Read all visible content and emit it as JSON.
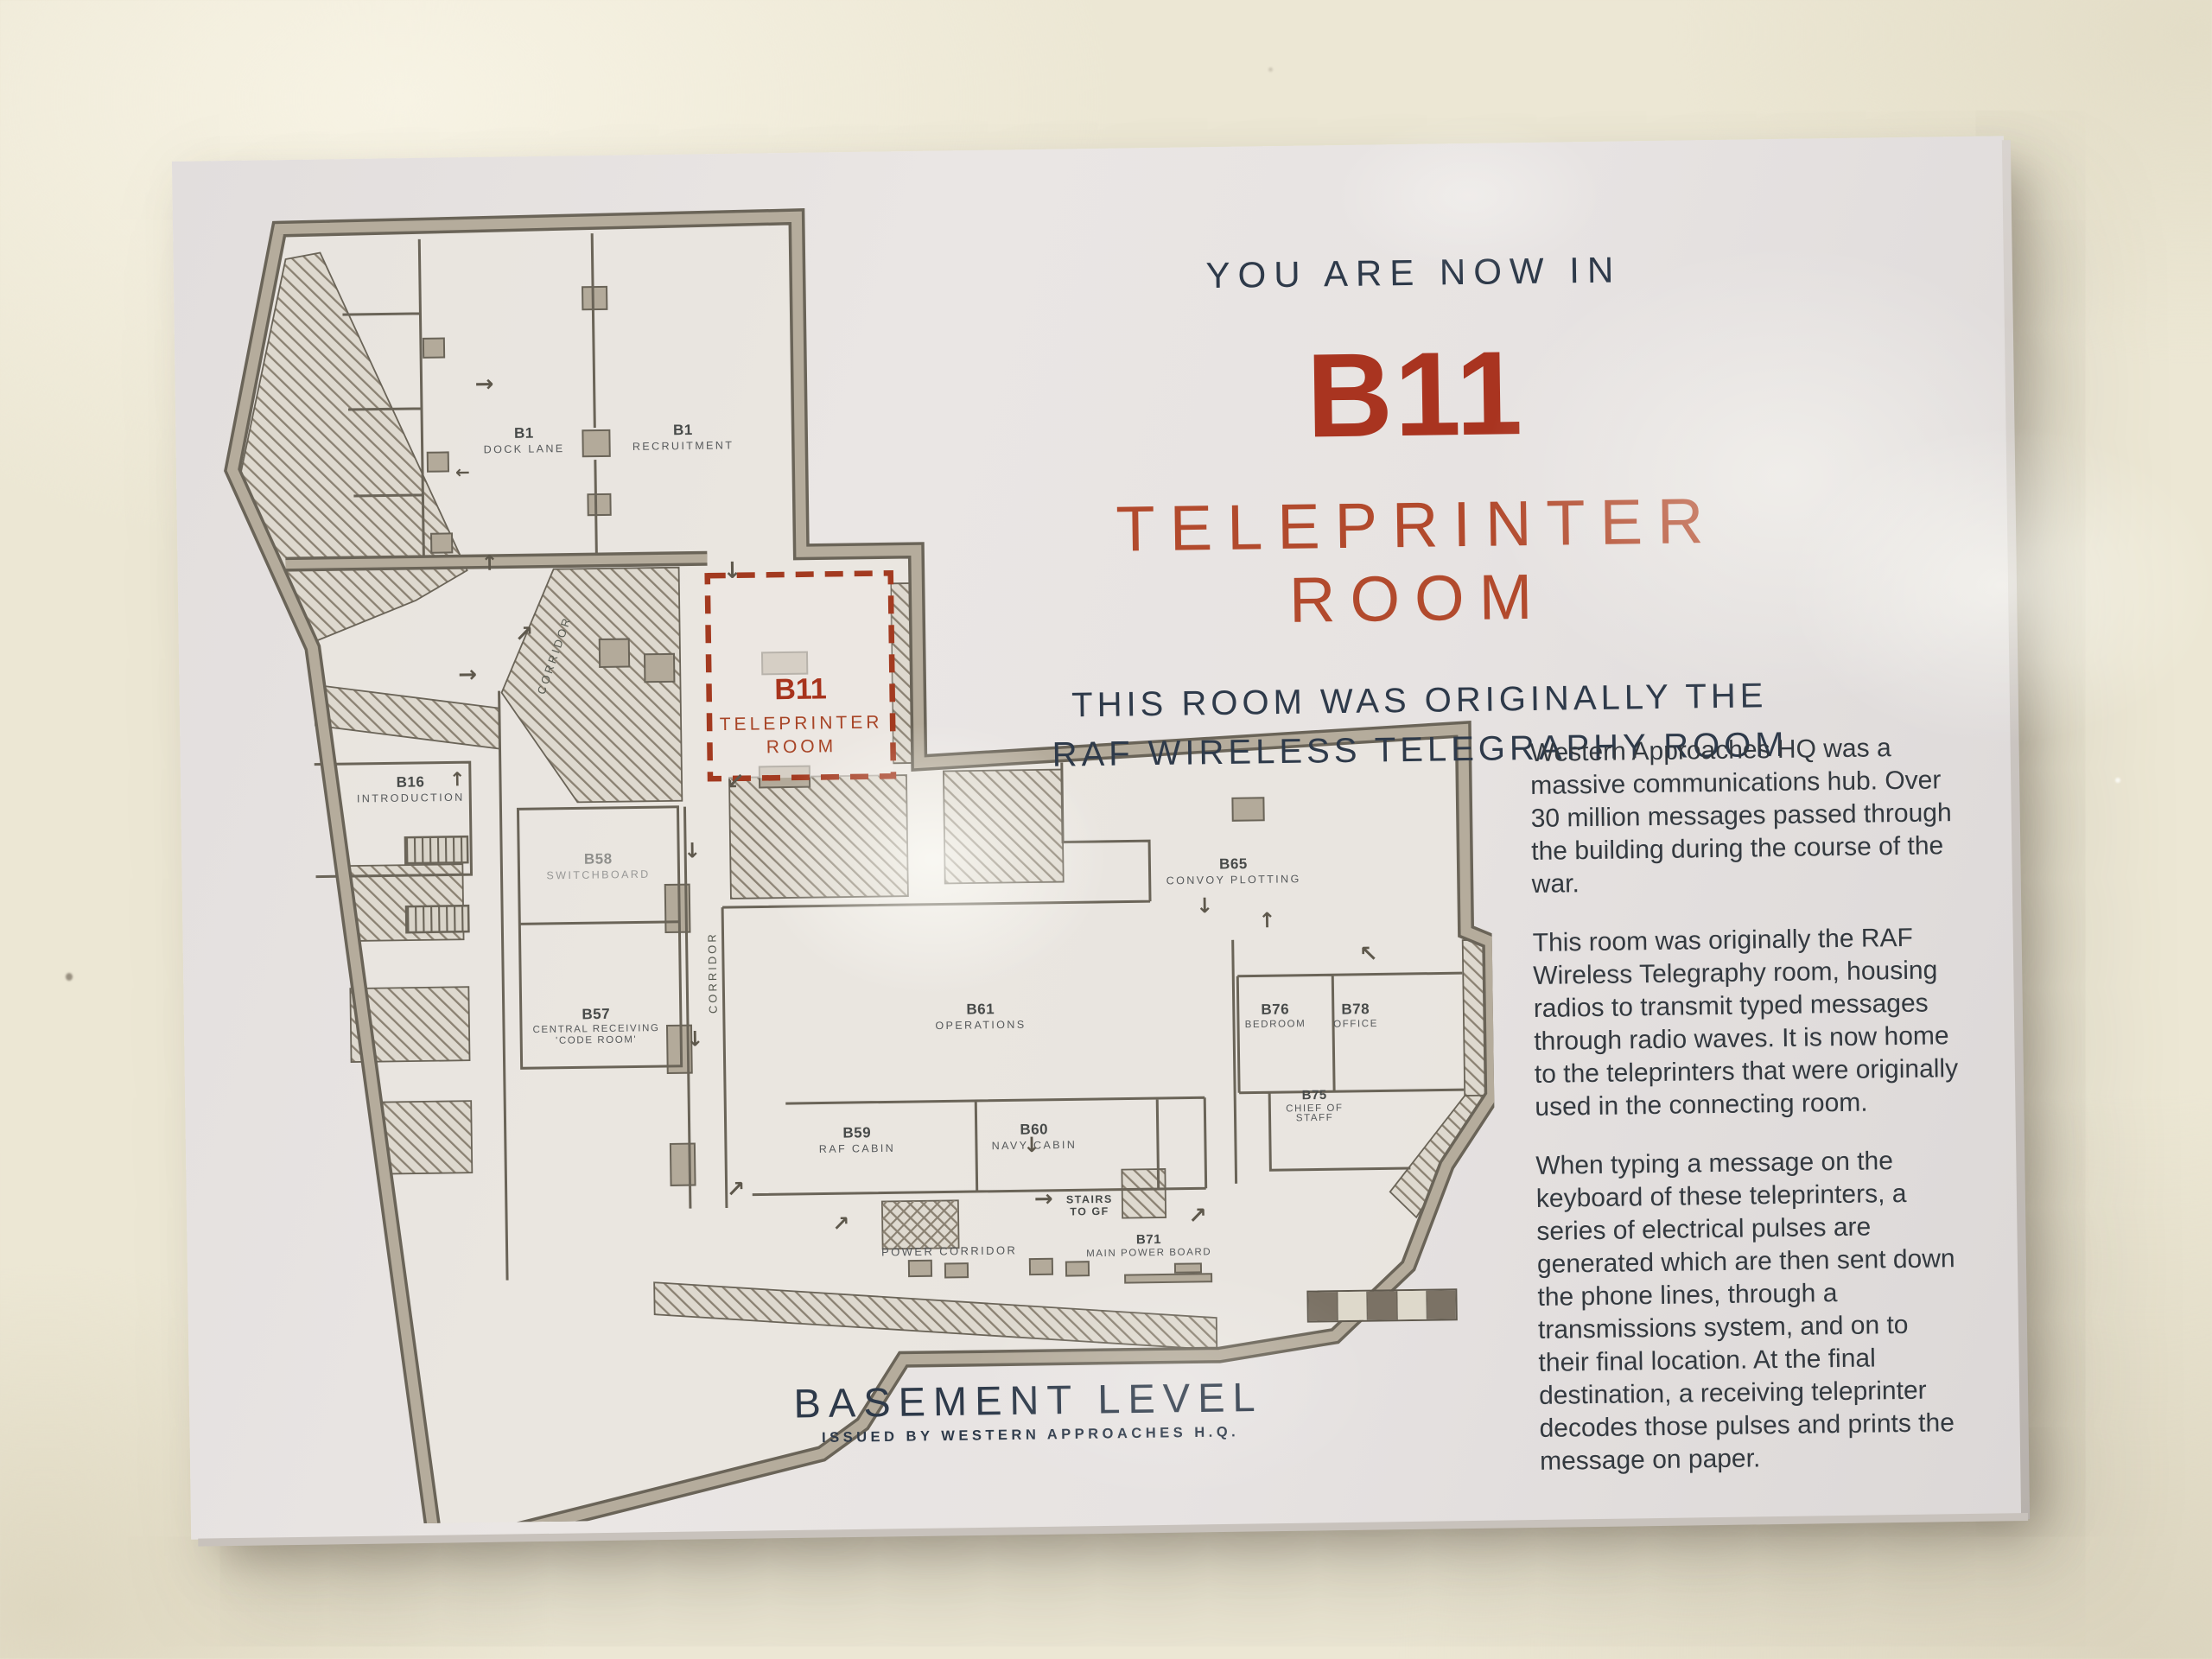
{
  "sign": {
    "header": {
      "kicker": "YOU ARE NOW IN",
      "room_code": "B11",
      "room_name": "TELEPRINTER ROOM",
      "subtitle_line1": "THIS ROOM WAS ORIGINALLY THE",
      "subtitle_line2": "RAF WIRELESS TELEGRAPHY ROOM"
    },
    "body": {
      "p1": "Western Approaches HQ was a massive communications hub. Over 30 million messages passed through the building during the course of the war.",
      "p2": "This room was originally the RAF Wireless Telegraphy room, housing radios to transmit typed messages through radio waves. It is now home to the teleprinters that were originally used in the connecting room.",
      "p3": "When typing a message on the keyboard of these teleprinters, a series of electrical pulses are generated which are then sent down the phone lines, through a transmissions system, and on to their final location. At the final destination, a receiving teleprinter decodes those pulses and prints the message on paper."
    },
    "plan": {
      "rooms": {
        "dock_lane": {
          "code": "B1",
          "name": "DOCK LANE"
        },
        "recruitment": {
          "code": "B1",
          "name": "RECRUITMENT"
        },
        "introduction": {
          "code": "B16",
          "name": "INTRODUCTION"
        },
        "teleprinter": {
          "code": "B11",
          "line1": "TELEPRINTER",
          "line2": "ROOM"
        },
        "switchboard": {
          "code": "B58",
          "name": "SWITCHBOARD"
        },
        "code_room": {
          "code": "B57",
          "line1": "CENTRAL RECEIVING",
          "line2": "'CODE ROOM'"
        },
        "convoy": {
          "code": "B65",
          "name": "CONVOY PLOTTING"
        },
        "operations": {
          "code": "B61",
          "name": "OPERATIONS"
        },
        "bedroom": {
          "code": "B76",
          "name": "BEDROOM"
        },
        "office": {
          "code": "B78",
          "name": "OFFICE"
        },
        "chief": {
          "code": "B75",
          "line1": "CHIEF OF",
          "line2": "STAFF"
        },
        "raf_cabin": {
          "code": "B59",
          "name": "RAF CABIN"
        },
        "navy_cabin": {
          "code": "B60",
          "name": "NAVY CABIN"
        },
        "power_board": {
          "code": "B71",
          "name": "MAIN POWER BOARD"
        }
      },
      "labels": {
        "corridor1": "CORRIDOR",
        "corridor2": "CORRIDOR",
        "power_corridor": "POWER CORRIDOR",
        "stairs_line1": "STAIRS",
        "stairs_line2": "TO GF"
      },
      "icons": {
        "arrow_up": "↑",
        "arrow_down": "↓",
        "arrow_right": "→",
        "arrow_left": "←",
        "arrow_up_right": "↗",
        "arrow_up_left": "↖",
        "arrow_down_left": "↙"
      }
    },
    "footer": {
      "title": "BASEMENT LEVEL",
      "issued": "ISSUED BY WESTERN APPROACHES H.Q."
    },
    "colors": {
      "accent_red": "#a93420",
      "accent_red_light": "#b24a2d",
      "heading_navy": "#2e3a4a",
      "plan_ink": "#6a6458",
      "wall_fill": "#b5ac9c",
      "sign_face": "#e7e3e2",
      "wall_background": "#ece7d4"
    }
  }
}
